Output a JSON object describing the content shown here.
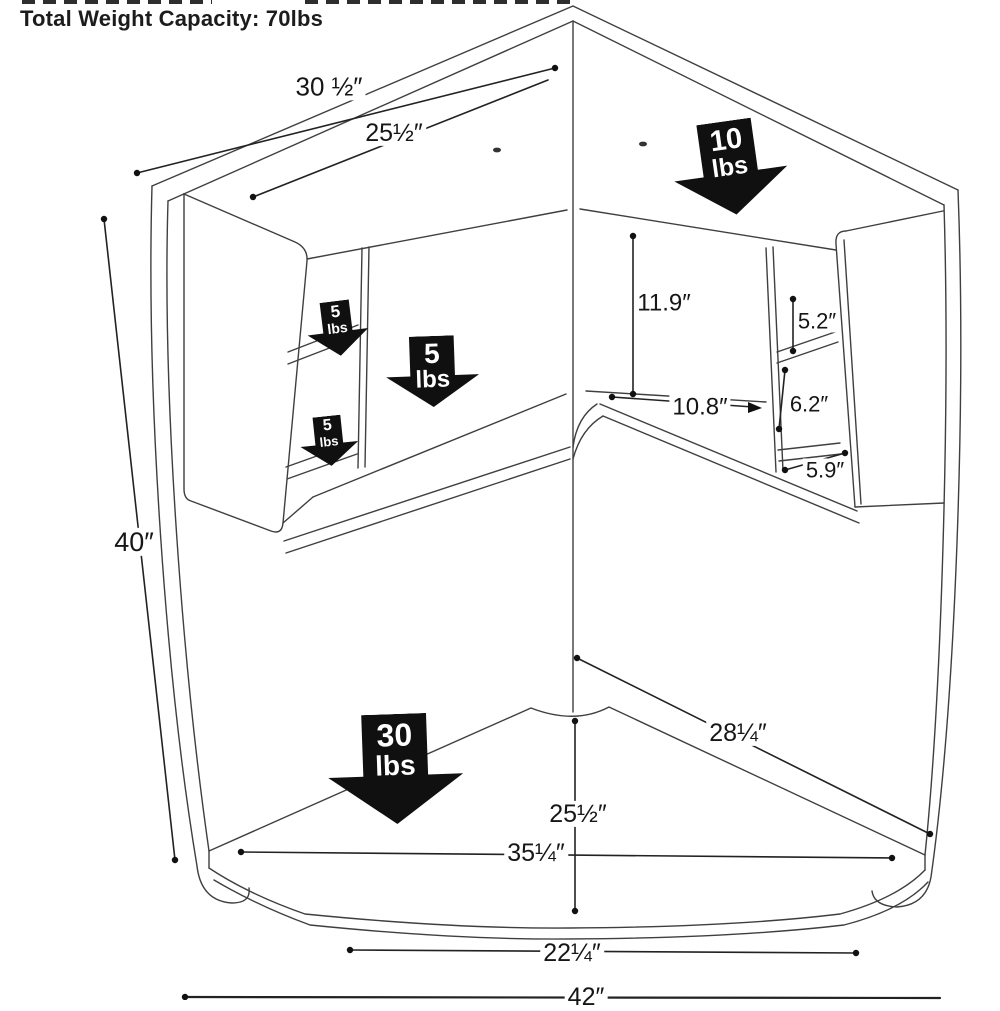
{
  "title": "Total Weight Capacity: 70lbs",
  "dimensions": {
    "top_width": "30 ½″",
    "hutch_width": "25½″",
    "overall_height": "40″",
    "cubby_height": "11.9″",
    "upper_shelf": "5.2″",
    "cubby_width": "10.8″",
    "middle_shelf": "6.2″",
    "lower_shelf": "5.9″",
    "side_depth": "28¼″",
    "center_depth": "25½″",
    "desktop_width": "35¼″",
    "front_width": "22¼″",
    "overall_width": "42″"
  },
  "weights": {
    "hutch_top": {
      "value": "10",
      "unit": "lbs"
    },
    "upper_left_shelf": {
      "value": "5",
      "unit": "lbs"
    },
    "center_shelf": {
      "value": "5",
      "unit": "lbs"
    },
    "lower_left_shelf": {
      "value": "5",
      "unit": "lbs"
    },
    "desktop": {
      "value": "30",
      "unit": "lbs"
    }
  },
  "colors": {
    "line": "#3f3f3f",
    "dimension": "#222222",
    "arrow": "#101010",
    "text": "#161616"
  }
}
